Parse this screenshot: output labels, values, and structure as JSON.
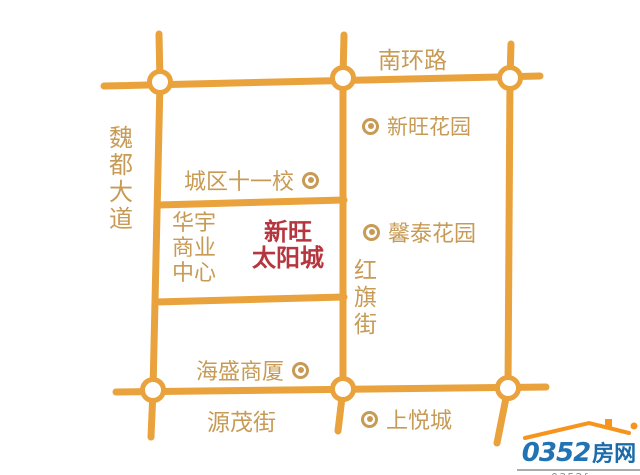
{
  "map": {
    "roads": {
      "nanhuan": "南环路",
      "weidu": "魏都大道",
      "hongqi": "红旗街",
      "yuanmao": "源茂街"
    },
    "pois": {
      "chengqu_school": "城区十一校",
      "xinwang_garden": "新旺花园",
      "xintai_garden": "馨泰花园",
      "huayu_center": "华宇商业中心",
      "haisheng_building": "海盛商厦",
      "shangyue_city": "上悦城"
    },
    "project": {
      "line1": "新旺",
      "line2": "太阳城"
    },
    "colors": {
      "road": "#E9A23C",
      "label": "#C79B55",
      "project_red": "#B5363F"
    }
  },
  "logo": {
    "number": "0352",
    "suffix": "房网",
    "url": "www.0352fang.com",
    "colors": {
      "blue": "#2173B4",
      "roof_orange": "#F7941E",
      "url_gray": "#8C8C8C"
    }
  }
}
